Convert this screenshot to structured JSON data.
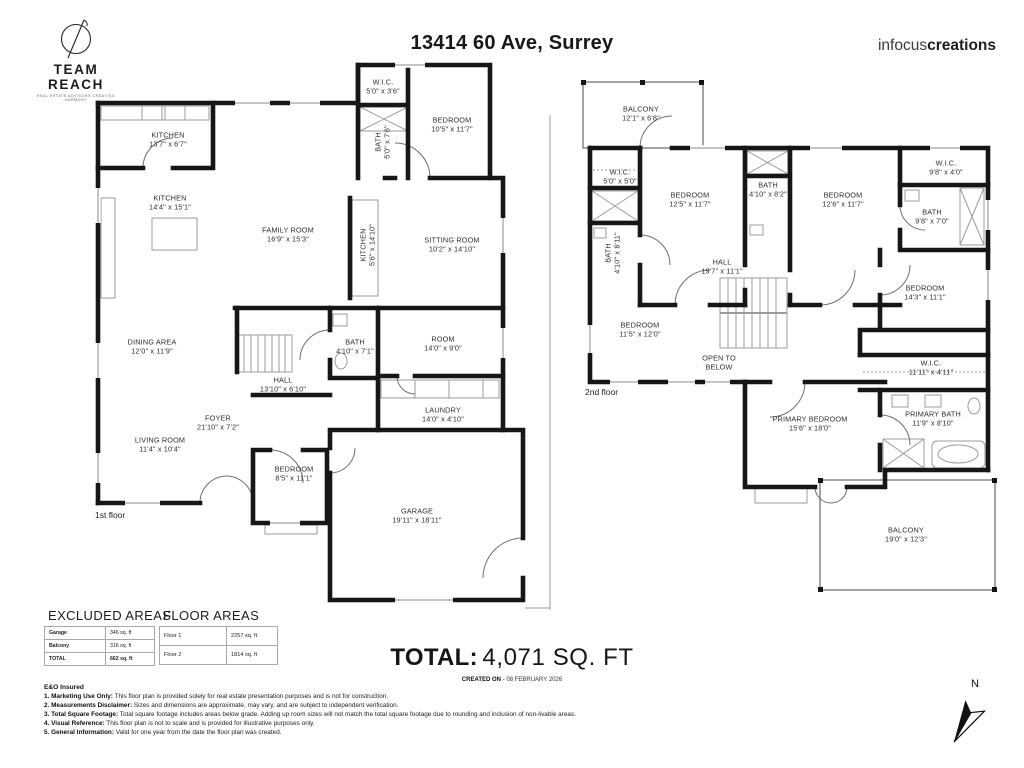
{
  "header": {
    "logo_title": "TEAM REACH",
    "logo_tagline": "REAL ESTATE ADVISORS CREATING HARMONY",
    "address": "13414 60 Ave, Surrey",
    "brand_light": "infocus",
    "brand_bold": "creations"
  },
  "colors": {
    "wall": "#161616",
    "light_line": "#9b9b9b",
    "text": "#2d2d2d"
  },
  "floor1": {
    "label": "1st floor",
    "rooms": [
      {
        "name": "KITCHEN",
        "dims": "13'7\" x 6'7\""
      },
      {
        "name": "W.I.C.",
        "dims": "5'0\" x 3'6\""
      },
      {
        "name": "BATH",
        "dims": "5'0\" x 7'6\""
      },
      {
        "name": "BEDROOM",
        "dims": "10'5\" x 11'7\""
      },
      {
        "name": "KITCHEN",
        "dims": "14'4\" x 15'1\""
      },
      {
        "name": "FAMILY ROOM",
        "dims": "16'9\" x 15'3\""
      },
      {
        "name": "KITCHEN",
        "dims": "5'6\" x 14'10\""
      },
      {
        "name": "SITTING ROOM",
        "dims": "10'2\" x 14'10\""
      },
      {
        "name": "DINING AREA",
        "dims": "12'0\" x 11'9\""
      },
      {
        "name": "BATH",
        "dims": "4'10\" x 7'1\""
      },
      {
        "name": "ROOM",
        "dims": "14'0\" x 9'0\""
      },
      {
        "name": "HALL",
        "dims": "13'10\" x 6'10\""
      },
      {
        "name": "LAUNDRY",
        "dims": "14'0\" x 4'10\""
      },
      {
        "name": "LIVING ROOM",
        "dims": "11'4\" x 10'4\""
      },
      {
        "name": "FOYER",
        "dims": "21'10\" x 7'2\""
      },
      {
        "name": "BEDROOM",
        "dims": "8'5\" x 11'1\""
      },
      {
        "name": "GARAGE",
        "dims": "19'11\" x 18'11\""
      }
    ]
  },
  "floor2": {
    "label": "2nd floor",
    "open_to_below": "OPEN TO BELOW",
    "rooms": [
      {
        "name": "BALCONY",
        "dims": "12'1\" x 6'8\""
      },
      {
        "name": "W.I.C.",
        "dims": "5'0\" x 5'0\""
      },
      {
        "name": "BEDROOM",
        "dims": "12'5\" x 11'7\""
      },
      {
        "name": "BATH",
        "dims": "4'10\" x 8'2\""
      },
      {
        "name": "BEDROOM",
        "dims": "12'6\" x 11'7\""
      },
      {
        "name": "W.I.C.",
        "dims": "9'8\" x 4'0\""
      },
      {
        "name": "BATH",
        "dims": "9'8\" x 7'0\""
      },
      {
        "name": "BATH",
        "dims": "4'10\" x 8'11\""
      },
      {
        "name": "HALL",
        "dims": "19'7\" x 11'1\""
      },
      {
        "name": "BEDROOM",
        "dims": "11'5\" x 12'0\""
      },
      {
        "name": "BEDROOM",
        "dims": "14'3\" x 11'1\""
      },
      {
        "name": "W.I.C.",
        "dims": "11'11\" x 4'11\""
      },
      {
        "name": "PRIMARY BEDROOM",
        "dims": "15'6\" x 18'0\""
      },
      {
        "name": "PRIMARY BATH",
        "dims": "11'9\" x 8'10\""
      },
      {
        "name": "BALCONY",
        "dims": "19'0\" x 12'3\""
      }
    ]
  },
  "excluded_areas": {
    "title": "EXCLUDED AREAS",
    "rows": [
      {
        "label": "Garage",
        "value": "346 sq. ft"
      },
      {
        "label": "Balcony",
        "value": "316 sq. ft"
      },
      {
        "label": "TOTAL",
        "value": "662 sq. ft"
      }
    ]
  },
  "floor_areas": {
    "title": "FLOOR AREAS",
    "rows": [
      {
        "label": "Floor 1",
        "value": "2257 sq. ft"
      },
      {
        "label": "Floor 2",
        "value": "1814 sq. ft"
      }
    ]
  },
  "total": {
    "label": "TOTAL:",
    "value": "4,071 SQ. FT"
  },
  "created": {
    "label": "CREATED ON",
    "value": "- 08 FEBRUARY 2026"
  },
  "disclaimers": {
    "heading": "E&O Insured",
    "items": [
      {
        "bold": "1. Marketing Use Only:",
        "text": " This floor plan is provided solely for real estate presentation purposes and is not for construction."
      },
      {
        "bold": "2. Measurements Disclaimer:",
        "text": " Sizes and dimensions are approximate, may vary, and are subject to independent verification."
      },
      {
        "bold": "3. Total Square Footage:",
        "text": " Total square footage includes areas below grade. Adding up room sizes will not match the total square footage due to rounding and inclusion of non-livable areas."
      },
      {
        "bold": "4. Visual Reference:",
        "text": " This floor plan is not to scale and is provided for illustrative purposes only."
      },
      {
        "bold": "5. General Information:",
        "text": " Valid for one year from the date the floor plan was created."
      }
    ]
  },
  "compass": {
    "label": "N"
  }
}
